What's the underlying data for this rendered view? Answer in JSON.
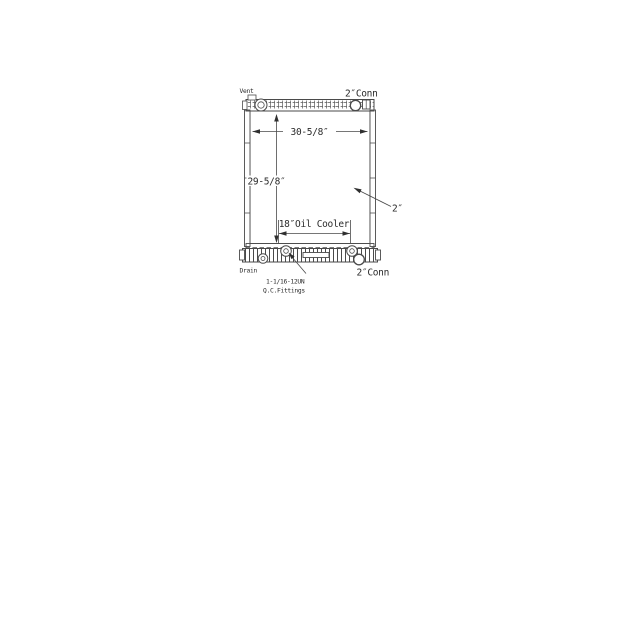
{
  "page": {
    "background": "#ffffff",
    "line_color": "#4a4a4a",
    "text_color": "#2b2b2b"
  },
  "diagram": {
    "kind": "radiator-outline-dimension-drawing",
    "labels": {
      "vent": "Vent",
      "top_conn": "2″Conn",
      "width": "30-5/8″",
      "height": "29-5/8″",
      "oil_cooler": "18″Oil Cooler",
      "depth": "2″",
      "drain": "Drain",
      "fitting_spec_line1": "1-1/16-12UN",
      "fitting_spec_line2": "Q.C.Fittings",
      "bottom_conn": "2″Conn"
    }
  }
}
